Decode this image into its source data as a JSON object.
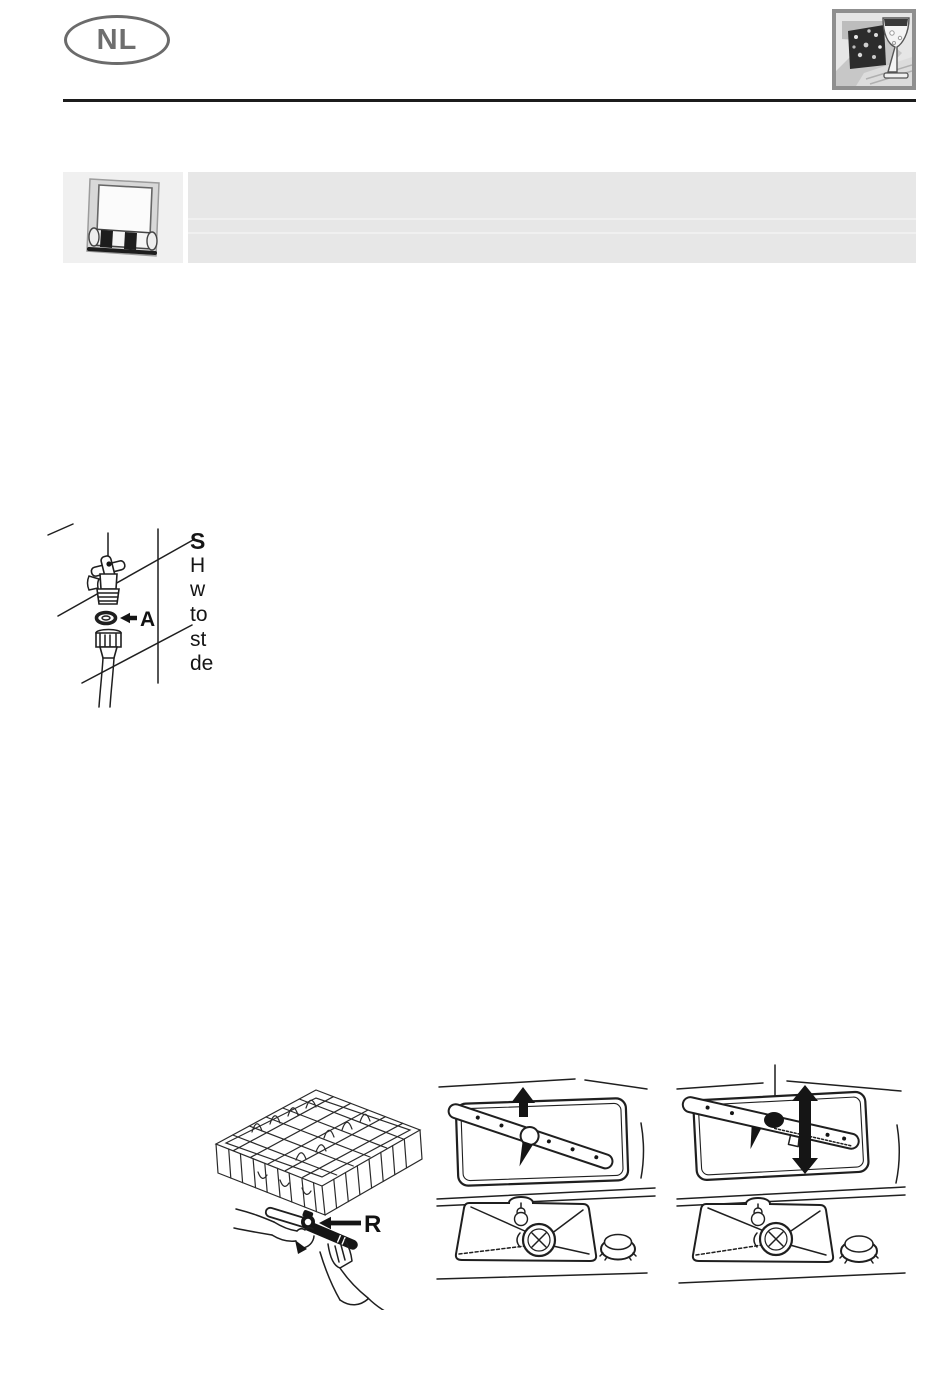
{
  "header": {
    "language_badge": "NL",
    "icon": "dishwasher-basket-and-glass-icon",
    "rule_color": "#1c1c1c"
  },
  "note_banner": {
    "icon": "detergent-dispenser-icon",
    "icon_box_bg": "#f0f0f0",
    "text_box_bg": "#e7e7e7",
    "text": ""
  },
  "tap_figure": {
    "icon": "water-tap-hose-filter-diagram",
    "callout": {
      "arrow_icon": "left-arrow-icon",
      "label": "A"
    }
  },
  "clipped_text": {
    "lines": [
      "S",
      "H",
      "w",
      "to",
      "st",
      "de"
    ]
  },
  "bottom_figures": {
    "rack": {
      "icon": "lower-basket-and-spray-arm-diagram",
      "callout": {
        "arrow_icon": "left-arrow-icon",
        "label": "R"
      }
    },
    "spray_arm_up": {
      "icon": "spray-arm-lift-diagram",
      "arrow_icon": "up-arrow-icon"
    },
    "spray_arm_updown": {
      "icon": "spray-arm-fit-diagram",
      "arrow_icon": "up-down-arrow-icon"
    }
  },
  "colors": {
    "rule": "#1c1c1c",
    "badge_gray": "#6e6e6e",
    "banner_bg": "#e7e7e7",
    "icon_box_bg": "#f0f0f0",
    "line_art": "#1f1f1f"
  }
}
